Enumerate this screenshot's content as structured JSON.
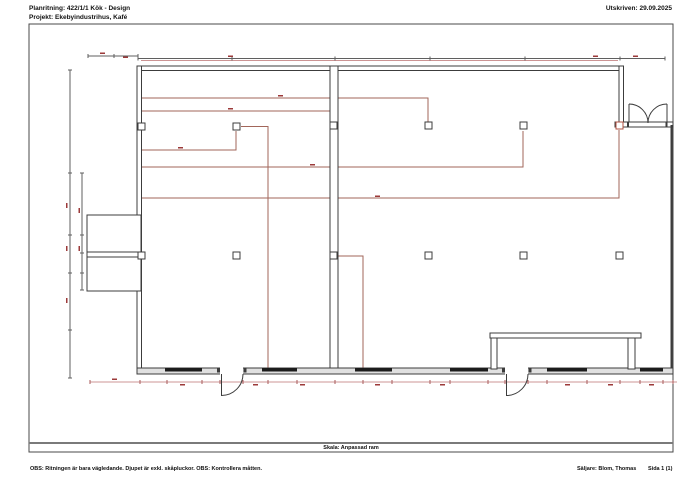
{
  "meta": {
    "title_line1": "Planritning:  422/1/1  Kök - Design",
    "title_line2": "Projekt:  Ekebyindustrihus, Kafé",
    "printed": "Utskriven: 29.09.2025"
  },
  "footer": {
    "scale_label": "Skala: Anpassad ram",
    "note": "OBS: Ritningen är bara vägledande. Djupet är exkl. skåpluckor. OBS: Kontrollera måtten.",
    "seller": "Säljare: Blom, Thomas",
    "page": "Sida 1 (1)"
  },
  "colors": {
    "wall": "#3c3c3c",
    "window": "#1c1c1c",
    "red": "#a2665a",
    "red_strong": "#b05040",
    "dim_dark": "#5f5f5f",
    "dim_red": "#cc9494",
    "tick_red": "#a85a5a",
    "label_red": "#9c3a3a",
    "wall_fill": "#e0e0e0",
    "frame": "#4a4a4a",
    "divider": "#7a7a7a"
  },
  "plan": {
    "frame": {
      "x": 29,
      "y": 24,
      "w": 644,
      "h": 428
    },
    "divider_y": 443,
    "walls": [
      {
        "x": 137,
        "y": 66,
        "w": 486,
        "h": 4.5
      },
      {
        "x": 137,
        "y": 66,
        "w": 4.5,
        "h": 308
      },
      {
        "x": 87,
        "y": 215,
        "w": 54,
        "h": 76
      },
      {
        "x": 87,
        "y": 252,
        "w": 54,
        "h": 5
      },
      {
        "x": 330,
        "y": 66,
        "w": 8,
        "h": 303
      },
      {
        "x": 619,
        "y": 66,
        "w": 4.5,
        "h": 58
      },
      {
        "x": 615,
        "y": 122,
        "w": 58,
        "h": 5
      },
      {
        "x": 137,
        "y": 368,
        "w": 536,
        "h": 6,
        "f": "wall_fill"
      },
      {
        "x": 490,
        "y": 333,
        "w": 151,
        "h": 5
      },
      {
        "x": 491,
        "y": 338,
        "w": 6,
        "h": 31
      },
      {
        "x": 628,
        "y": 338,
        "w": 7,
        "h": 31
      }
    ],
    "gaps": [
      {
        "x": 220,
        "y": 367,
        "w": 23,
        "h": 8
      },
      {
        "x": 505,
        "y": 367,
        "w": 23,
        "h": 8
      }
    ],
    "bars": [
      {
        "x": 670.5,
        "y": 125,
        "w": 2,
        "h": 243
      },
      {
        "x": 217,
        "y": 367.5,
        "w": 3,
        "h": 5
      },
      {
        "x": 243.5,
        "y": 367.5,
        "w": 3,
        "h": 5
      },
      {
        "x": 502,
        "y": 367.5,
        "w": 3,
        "h": 5
      },
      {
        "x": 528.5,
        "y": 367.5,
        "w": 3,
        "h": 5
      },
      {
        "x": 627,
        "y": 121.5,
        "w": 2,
        "h": 5.5
      },
      {
        "x": 665.5,
        "y": 121.5,
        "w": 2,
        "h": 5.5
      }
    ],
    "windows": [
      {
        "x": 165,
        "y": 368,
        "w": 37,
        "h": 3.5
      },
      {
        "x": 262,
        "y": 368,
        "w": 35,
        "h": 3.5
      },
      {
        "x": 355,
        "y": 368,
        "w": 37,
        "h": 3.5
      },
      {
        "x": 450,
        "y": 368,
        "w": 38,
        "h": 3.5
      },
      {
        "x": 547,
        "y": 368,
        "w": 40,
        "h": 3.5
      },
      {
        "x": 640,
        "y": 368,
        "w": 23,
        "h": 3.5
      }
    ],
    "redlines": [
      {
        "pts": [
          [
            141,
            98
          ],
          [
            428,
            98
          ],
          [
            428,
            122
          ]
        ]
      },
      {
        "pts": [
          [
            141,
            111
          ],
          [
            330,
            111
          ]
        ]
      },
      {
        "pts": [
          [
            141,
            150
          ],
          [
            236,
            150
          ],
          [
            236,
            131
          ]
        ]
      },
      {
        "pts": [
          [
            141,
            167
          ],
          [
            523,
            167
          ],
          [
            523,
            131
          ]
        ]
      },
      {
        "pts": [
          [
            141,
            198
          ],
          [
            619,
            198
          ],
          [
            619,
            130
          ]
        ]
      },
      {
        "pts": [
          [
            241,
            126.5
          ],
          [
            268,
            126.5
          ],
          [
            268,
            368
          ]
        ]
      },
      {
        "pts": [
          [
            338,
            256
          ],
          [
            363,
            256
          ],
          [
            363,
            368
          ]
        ]
      }
    ],
    "dims": [
      {
        "pts": [
          [
            88,
            56
          ],
          [
            138,
            56
          ]
        ]
      },
      {
        "pts": [
          [
            138,
            58.5
          ],
          [
            665,
            58.5
          ]
        ]
      },
      {
        "pts": [
          [
            141,
            60.5
          ],
          [
            618,
            60.5
          ]
        ],
        "red": true
      },
      {
        "pts": [
          [
            70,
            70
          ],
          [
            70,
            378
          ]
        ]
      },
      {
        "pts": [
          [
            82,
            173
          ],
          [
            82,
            290
          ]
        ]
      },
      {
        "pts": [
          [
            90,
            382
          ],
          [
            677,
            382
          ]
        ],
        "red": true
      }
    ],
    "tick_groups": [
      {
        "y": 56,
        "xs": [
          88,
          114,
          138
        ],
        "v": true,
        "red": false
      },
      {
        "y": 58.5,
        "xs": [
          138,
          232,
          335,
          430,
          525,
          620,
          665
        ],
        "v": true,
        "red": false
      },
      {
        "y": 382,
        "xs": [
          90,
          140,
          167,
          202,
          220,
          243,
          268,
          297,
          335,
          363,
          392,
          430,
          450,
          488,
          505,
          528,
          547,
          587,
          620,
          640,
          663,
          673
        ],
        "v": true,
        "red": true
      },
      {
        "x": 70,
        "ys": [
          70,
          173,
          235,
          273,
          330,
          378
        ],
        "v": false,
        "red": false
      },
      {
        "x": 82,
        "ys": [
          173,
          235,
          253,
          273,
          290
        ],
        "v": false,
        "red": false
      }
    ],
    "marks": [
      {
        "x": 278,
        "y": 95
      },
      {
        "x": 228,
        "y": 108
      },
      {
        "x": 178,
        "y": 147
      },
      {
        "x": 310,
        "y": 164
      },
      {
        "x": 375,
        "y": 195.5
      },
      {
        "x": 228,
        "y": 55.5
      },
      {
        "x": 100,
        "y": 52.5
      },
      {
        "x": 123,
        "y": 56.5
      },
      {
        "x": 593,
        "y": 55.5
      },
      {
        "x": 633,
        "y": 55.5
      },
      {
        "x": 66,
        "y": 203,
        "v": true
      },
      {
        "x": 66,
        "y": 246,
        "v": true
      },
      {
        "x": 66,
        "y": 298,
        "v": true
      },
      {
        "x": 78.5,
        "y": 208,
        "v": true
      },
      {
        "x": 78.5,
        "y": 246,
        "v": true
      },
      {
        "x": 112,
        "y": 378.5
      },
      {
        "x": 180,
        "y": 384
      },
      {
        "x": 253,
        "y": 384
      },
      {
        "x": 300,
        "y": 384
      },
      {
        "x": 375,
        "y": 384
      },
      {
        "x": 440,
        "y": 384
      },
      {
        "x": 565,
        "y": 384
      },
      {
        "x": 608,
        "y": 384
      },
      {
        "x": 649,
        "y": 384
      }
    ],
    "columns": [
      {
        "x": 138,
        "y": 123
      },
      {
        "x": 233,
        "y": 123
      },
      {
        "x": 330,
        "y": 122
      },
      {
        "x": 425,
        "y": 122
      },
      {
        "x": 520,
        "y": 122
      },
      {
        "x": 616,
        "y": 122,
        "red": true
      },
      {
        "x": 138,
        "y": 252
      },
      {
        "x": 233,
        "y": 252
      },
      {
        "x": 330,
        "y": 252
      },
      {
        "x": 425,
        "y": 252
      },
      {
        "x": 520,
        "y": 252
      },
      {
        "x": 616,
        "y": 252
      }
    ],
    "doors": [
      {
        "d": "M221.5,374 L221.5,396"
      },
      {
        "d": "M243,374 A21.5,21.5 0 0 1 221.5,395.5"
      },
      {
        "d": "M506.5,374 L506.5,396"
      },
      {
        "d": "M528,374 A21.5,21.5 0 0 1 506.5,395.5"
      },
      {
        "d": "M629,122 L629,104"
      },
      {
        "d": "M667,122 L667,104"
      },
      {
        "d": "M629,104 A19,19 0 0 1 648,123"
      },
      {
        "d": "M667,104 A19,19 0 0 0 648,123"
      }
    ]
  }
}
